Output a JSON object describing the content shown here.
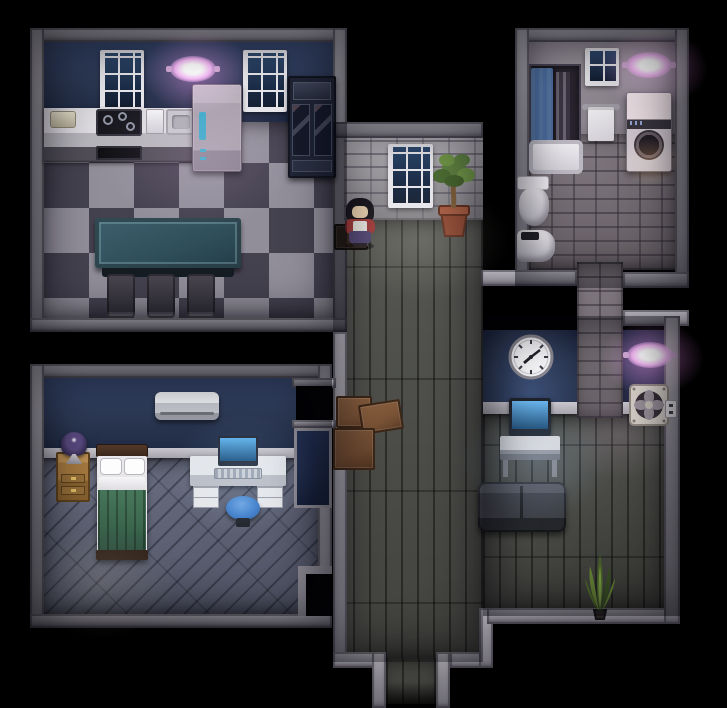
{
  "scene": {
    "title": "Top-down apartment interior at night",
    "style": "pixel-art RPG map",
    "lighting": "dark with pink ceiling lamps and monitor glow"
  },
  "colors": {
    "stone": "#9c99a2",
    "navy": "#2b3752",
    "brick": "#a3a0a6",
    "stucco": "#8e8791",
    "checker_light": "#918e9a",
    "checker_dark": "#454250",
    "wood": "#4b4c47",
    "diag": "#61657a",
    "tile": "#7b737a",
    "accent": "#ee86f2",
    "teal": "#2f4e5a",
    "green": "#3c684e",
    "stool": "#3f7cc9",
    "screen": "#54a4e4",
    "box": "#7a5336",
    "pot": "#9c4f33",
    "curtain": "#4a6b9e"
  },
  "rooms": {
    "kitchen": {
      "label": "Kitchen",
      "window": "Window",
      "ceiling_light": "Pink ceiling light",
      "counter": "Kitchen counter",
      "breadbox": "Breadbox",
      "stove": "Stovetop",
      "dishwasher": "Dishwasher",
      "sink": "Kitchen sink",
      "refrigerator": "Refrigerator",
      "cabinet": "China cabinet",
      "table": "Dining table",
      "chair": "Chair",
      "floor": "Checkered tile floor"
    },
    "hallway": {
      "label": "Hallway",
      "window": "Window",
      "plant": "Potted tree",
      "boxes": "Cardboard boxes",
      "floor": "Wood plank floor",
      "exit": "Exit corridor"
    },
    "bathroom": {
      "label": "Bathroom",
      "window": "Window",
      "ceiling_light": "Pink ceiling light",
      "shower": "Shower with blue curtain",
      "towel": "Towel rack",
      "washer": "Washing machine",
      "urinal": "Urinal",
      "basin": "Wash basin",
      "floor": "Stone tile floor",
      "corridor": "Tiled passage"
    },
    "study": {
      "label": "Computer nook",
      "clock": "Wall clock",
      "monitor": "Computer on table",
      "bench": "Bench",
      "floor": "Wood plank floor"
    },
    "utility": {
      "label": "Utility wall",
      "ceiling_light": "Pink ceiling light",
      "fan": "Ventilation fan",
      "outlet": "Power outlet",
      "plant": "Snake plant"
    },
    "bedroom": {
      "label": "Bedroom",
      "ac": "Air conditioner",
      "lamp": "Bedside lamp",
      "nightstand": "Nightstand",
      "bed": "Bed with green blanket",
      "desk": "Computer desk",
      "monitor": "Computer",
      "stool": "Blue stool",
      "doorway": "Doorway",
      "floor": "Wood plank floor"
    }
  },
  "character": {
    "label": "Dark-haired woman in red and white outfit",
    "stand": "Small wooden stand"
  }
}
